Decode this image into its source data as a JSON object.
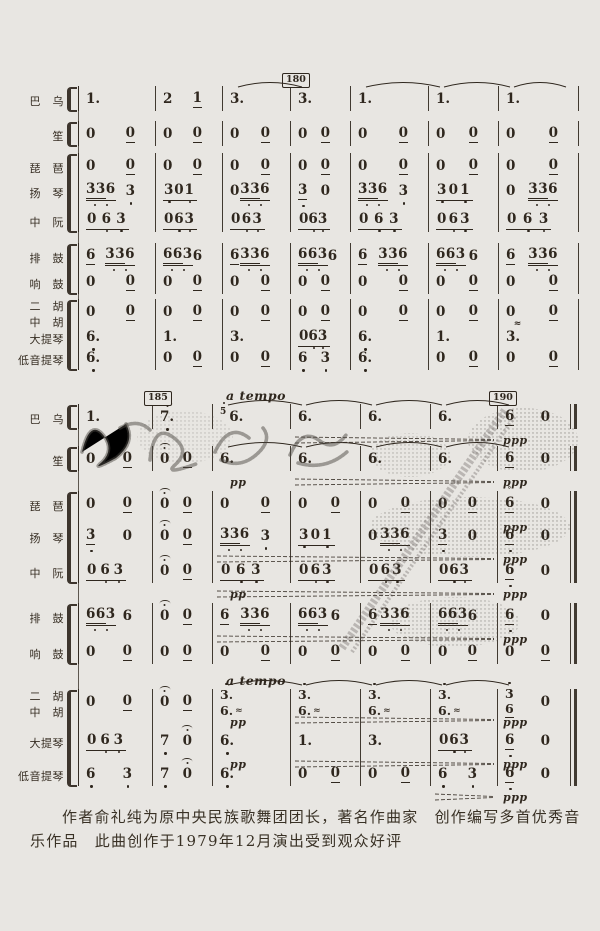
{
  "page": {
    "background": "#e8e6e2",
    "ink": "#2f271e",
    "watermark_color": "#4e4a44",
    "kind": "scanned jianpu ensemble score page"
  },
  "score": {
    "instruments": [
      "巴乌",
      "笙",
      "琵琶",
      "扬琴",
      "中阮",
      "排鼓",
      "响鼓",
      "二胡",
      "中胡",
      "大提琴",
      "低音提琴"
    ],
    "rehearsal_marks": [
      {
        "label": "180",
        "system": 0,
        "at_barline": 3
      },
      {
        "label": "185",
        "system": 1,
        "at_barline": 1
      },
      {
        "label": "190",
        "system": 1,
        "at_barline": 6
      }
    ],
    "tempo_texts": [
      {
        "text": "a tempo",
        "system": 1,
        "row": 0,
        "at_barline": 2
      },
      {
        "text": "a tempo",
        "system": 1,
        "row": 7,
        "at_barline": 2
      }
    ],
    "dynamics": [
      {
        "text": "pp",
        "system": 1,
        "row": 1,
        "measure": 2
      },
      {
        "text": "pp",
        "system": 1,
        "row": 4,
        "measure": 2
      },
      {
        "text": "pp",
        "system": 1,
        "row": 7,
        "measure": 2
      },
      {
        "text": "pp",
        "system": 1,
        "row": 8,
        "measure": 2
      },
      {
        "text": "ppp",
        "system": 1,
        "row": 0,
        "measure": 6
      },
      {
        "text": "ppp",
        "system": 1,
        "row": 1,
        "measure": 6
      },
      {
        "text": "ppp",
        "system": 1,
        "row": 2,
        "measure": 6
      },
      {
        "text": "ppp",
        "system": 1,
        "row": 3,
        "measure": 6
      },
      {
        "text": "ppp",
        "system": 1,
        "row": 4,
        "measure": 6
      },
      {
        "text": "ppp",
        "system": 1,
        "row": 5,
        "measure": 6
      },
      {
        "text": "ppp",
        "system": 1,
        "row": 7,
        "measure": 6
      },
      {
        "text": "ppp",
        "system": 1,
        "row": 8,
        "measure": 6
      },
      {
        "text": "ppp",
        "system": 1,
        "row": 9,
        "measure": 6
      }
    ],
    "ties": [
      {
        "system": 0,
        "row": 0,
        "pairs": [
          [
            2,
            3
          ],
          [
            4,
            5
          ],
          [
            5,
            6
          ],
          [
            6,
            7
          ]
        ]
      },
      {
        "system": 1,
        "row": 0,
        "pairs": [
          [
            2,
            3
          ],
          [
            3,
            4
          ],
          [
            4,
            5
          ],
          [
            5,
            6
          ]
        ]
      },
      {
        "system": 1,
        "row": 1,
        "pairs": [
          [
            2,
            3
          ],
          [
            3,
            4
          ],
          [
            4,
            5
          ],
          [
            5,
            6
          ]
        ]
      },
      {
        "system": 1,
        "row": 7,
        "pairs": [
          [
            2,
            3
          ],
          [
            3,
            4
          ],
          [
            4,
            5
          ],
          [
            5,
            6
          ]
        ]
      }
    ],
    "hairpins": [
      {
        "system": 1,
        "row": 0,
        "from": 3,
        "to": 6
      },
      {
        "system": 1,
        "row": 1,
        "from": 3,
        "to": 6
      },
      {
        "system": 1,
        "row": 3,
        "from": 2,
        "to": 6
      },
      {
        "system": 1,
        "row": 4,
        "from": 2,
        "to": 6
      },
      {
        "system": 1,
        "row": 5,
        "from": 2,
        "to": 6
      },
      {
        "system": 1,
        "row": 7,
        "from": 3,
        "to": 6
      },
      {
        "system": 1,
        "row": 8,
        "from": 3,
        "to": 6
      },
      {
        "system": 1,
        "row": 9,
        "from": 5,
        "to": 6
      }
    ],
    "systems": [
      {
        "rows": [
          {
            "label": "巴　乌",
            "measures": [
              [
                "1."
              ],
              [
                "2",
                "1|u"
              ],
              [
                "3."
              ],
              [
                "3."
              ],
              [
                "1."
              ],
              [
                "1."
              ],
              [
                "1."
              ]
            ]
          },
          {
            "label": "笙",
            "measures": [
              [
                "0",
                "0|u"
              ],
              [
                "0",
                "0|u"
              ],
              [
                "0",
                "0|u"
              ],
              [
                "0",
                "0|u"
              ],
              [
                "0",
                "0|u"
              ],
              [
                "0",
                "0|u"
              ],
              [
                "0",
                "0|u"
              ]
            ]
          },
          {
            "label": "琵　琶",
            "measures": [
              [
                "0",
                "0|u"
              ],
              [
                "0",
                "0|u"
              ],
              [
                "0",
                "0|u"
              ],
              [
                "0",
                "0|u"
              ],
              [
                "0",
                "0|u"
              ],
              [
                "0",
                "0|u"
              ],
              [
                "0",
                "0|u"
              ]
            ]
          },
          {
            "label": "扬　琴",
            "measures": [
              [
                {
                  "b": "336"
                },
                "3|d"
              ],
              [
                {
                  "G": "3 0 1"
                }
              ],
              [
                "0",
                {
                  "b": "336"
                }
              ],
              [
                "3|ud",
                "0"
              ],
              [
                {
                  "b": "336"
                },
                "3|d"
              ],
              [
                {
                  "G": "3 0 1"
                }
              ],
              [
                "0",
                {
                  "b": "336"
                }
              ]
            ]
          },
          {
            "label": "中　阮",
            "measures": [
              [
                {
                  "G": "0 6 3"
                }
              ],
              [
                {
                  "G": "0 6 3"
                }
              ],
              [
                {
                  "G": "0 6 3"
                }
              ],
              [
                {
                  "G": "0 6 3"
                }
              ],
              [
                {
                  "G": "0 6 3"
                }
              ],
              [
                {
                  "G": "0 6 3"
                }
              ],
              [
                {
                  "G": "0 6 3"
                }
              ]
            ]
          },
          {
            "label": "排　鼓",
            "measures": [
              [
                "6|u",
                {
                  "b": "336"
                }
              ],
              [
                {
                  "b": "663"
                },
                "6"
              ],
              [
                "6|u",
                {
                  "b": "336"
                }
              ],
              [
                {
                  "b": "663"
                },
                "6"
              ],
              [
                "6|u",
                {
                  "b": "336"
                }
              ],
              [
                {
                  "b": "663"
                },
                "6"
              ],
              [
                "6|u",
                {
                  "b": "336"
                }
              ]
            ]
          },
          {
            "label": "响　鼓",
            "measures": [
              [
                "0",
                "0|u"
              ],
              [
                "0",
                "0|u"
              ],
              [
                "0",
                "0|u"
              ],
              [
                "0",
                "0|u"
              ],
              [
                "0",
                "0|u"
              ],
              [
                "0",
                "0|u"
              ],
              [
                "0",
                "0|u"
              ]
            ]
          },
          {
            "label": "二　胡",
            "label2": "中　胡",
            "measures": [
              [
                "0",
                "0|u"
              ],
              [
                "0",
                "0|u"
              ],
              [
                "0",
                "0|u"
              ],
              [
                "0",
                "0|u"
              ],
              [
                "0",
                "0|u"
              ],
              [
                "0",
                "0|u"
              ],
              [
                "0",
                "0|u"
              ]
            ]
          },
          {
            "label": "大提琴",
            "measures": [
              [
                "6.|d"
              ],
              [
                "1."
              ],
              [
                "3."
              ],
              [
                {
                  "G": "0 6 3"
                }
              ],
              [
                "6.|d"
              ],
              [
                "1."
              ],
              [
                "3.|w"
              ]
            ]
          },
          {
            "label": "低音提琴",
            "measures": [
              [
                "6.|d"
              ],
              [
                "0",
                "0|u"
              ],
              [
                "0",
                "0|u"
              ],
              [
                "6|d",
                "3|d"
              ],
              [
                "6.|d"
              ],
              [
                "0",
                "0|u"
              ],
              [
                "0",
                "0|u"
              ]
            ]
          }
        ]
      },
      {
        "rows": [
          {
            "label": "巴　乌",
            "measures": [
              [
                "1."
              ],
              [
                "7.|df"
              ],
              [
                "5|sD",
                "6."
              ],
              [
                "6."
              ],
              [
                "6."
              ],
              [
                "6."
              ],
              [
                "6|u",
                "0"
              ]
            ]
          },
          {
            "label": "笙",
            "measures": [
              [
                "0",
                "0|u"
              ],
              [
                "0|f",
                "0|u"
              ],
              [
                "6."
              ],
              [
                "6."
              ],
              [
                "6."
              ],
              [
                "6."
              ],
              [
                "6|u",
                "0"
              ]
            ]
          },
          {
            "label": "琵　琶",
            "measures": [
              [
                "0",
                "0|u"
              ],
              [
                "0|f",
                "0|u"
              ],
              [
                "0",
                "0|u"
              ],
              [
                "0",
                "0|u"
              ],
              [
                "0",
                "0|u"
              ],
              [
                "0",
                "0|u"
              ],
              [
                "6|uh",
                "0"
              ]
            ]
          },
          {
            "label": "扬　琴",
            "measures": [
              [
                "3|ud",
                "0"
              ],
              [
                "0|f",
                "0|u"
              ],
              [
                {
                  "b": "336"
                },
                "3|d"
              ],
              [
                {
                  "G": "3 0 1"
                }
              ],
              [
                "0",
                {
                  "b": "336"
                }
              ],
              [
                "3|ud",
                "0"
              ],
              [
                "6|ud",
                "0"
              ]
            ]
          },
          {
            "label": "中　阮",
            "measures": [
              [
                {
                  "G": "0 6 3"
                }
              ],
              [
                "0|f",
                "0|u"
              ],
              [
                {
                  "G": "0 6 3"
                }
              ],
              [
                {
                  "G": "0 6 3"
                }
              ],
              [
                {
                  "G": "0 6 3"
                }
              ],
              [
                {
                  "G": "0 6 3"
                }
              ],
              [
                "6|ud",
                "0"
              ]
            ]
          },
          {
            "label": "排　鼓",
            "measures": [
              [
                {
                  "b": "663"
                },
                "6"
              ],
              [
                "0|f",
                "0|u"
              ],
              [
                "6|u",
                {
                  "b": "336"
                }
              ],
              [
                {
                  "b": "663"
                },
                "6"
              ],
              [
                "6|u",
                {
                  "b": "336"
                }
              ],
              [
                {
                  "b": "663"
                },
                "6"
              ],
              [
                "6|ud",
                "0"
              ]
            ]
          },
          {
            "label": "响　鼓",
            "measures": [
              [
                "0",
                "0|u"
              ],
              [
                "0",
                "0|u"
              ],
              [
                "0",
                "0|u"
              ],
              [
                "0",
                "0|u"
              ],
              [
                "0",
                "0|u"
              ],
              [
                "0",
                "0|u"
              ],
              [
                "0",
                "0|u"
              ]
            ]
          },
          {
            "label": "二　胡",
            "label2": "中　胡",
            "measures": [
              [
                "0",
                "0|u"
              ],
              [
                "0|f",
                "0|u"
              ],
              [
                {
                  "s": [
                    "3.|D",
                    "6.|r"
                  ]
                }
              ],
              [
                {
                  "s": [
                    "3.|D",
                    "6.|r"
                  ]
                }
              ],
              [
                {
                  "s": [
                    "3.|D",
                    "6.|r"
                  ]
                }
              ],
              [
                {
                  "s": [
                    "3.|D",
                    "6.|r"
                  ]
                }
              ],
              [
                {
                  "s": [
                    "3|D",
                    "6|u"
                  ]
                },
                "0"
              ]
            ]
          },
          {
            "label": "大提琴",
            "measures": [
              [
                {
                  "G": "0 6 3"
                }
              ],
              [
                "7|d",
                "0|f"
              ],
              [
                "6.|d"
              ],
              [
                "1."
              ],
              [
                "3."
              ],
              [
                {
                  "G": "0 6 3"
                }
              ],
              [
                "6|ud",
                "0"
              ]
            ]
          },
          {
            "label": "低音提琴",
            "measures": [
              [
                "6|d",
                "3|d"
              ],
              [
                "7|d",
                "0|f"
              ],
              [
                "6.|d"
              ],
              [
                "0",
                "0|u"
              ],
              [
                "0",
                "0|u"
              ],
              [
                "6|d",
                "3|d"
              ],
              [
                "6|ud",
                "0"
              ]
            ]
          }
        ]
      }
    ]
  },
  "footer": {
    "line1": "作者俞礼纯为原中央民族歌舞团团长，著名作曲家　创作编写多首优秀音",
    "line2": "乐作品　此曲创作于1979年12月演出受到观众好评"
  }
}
